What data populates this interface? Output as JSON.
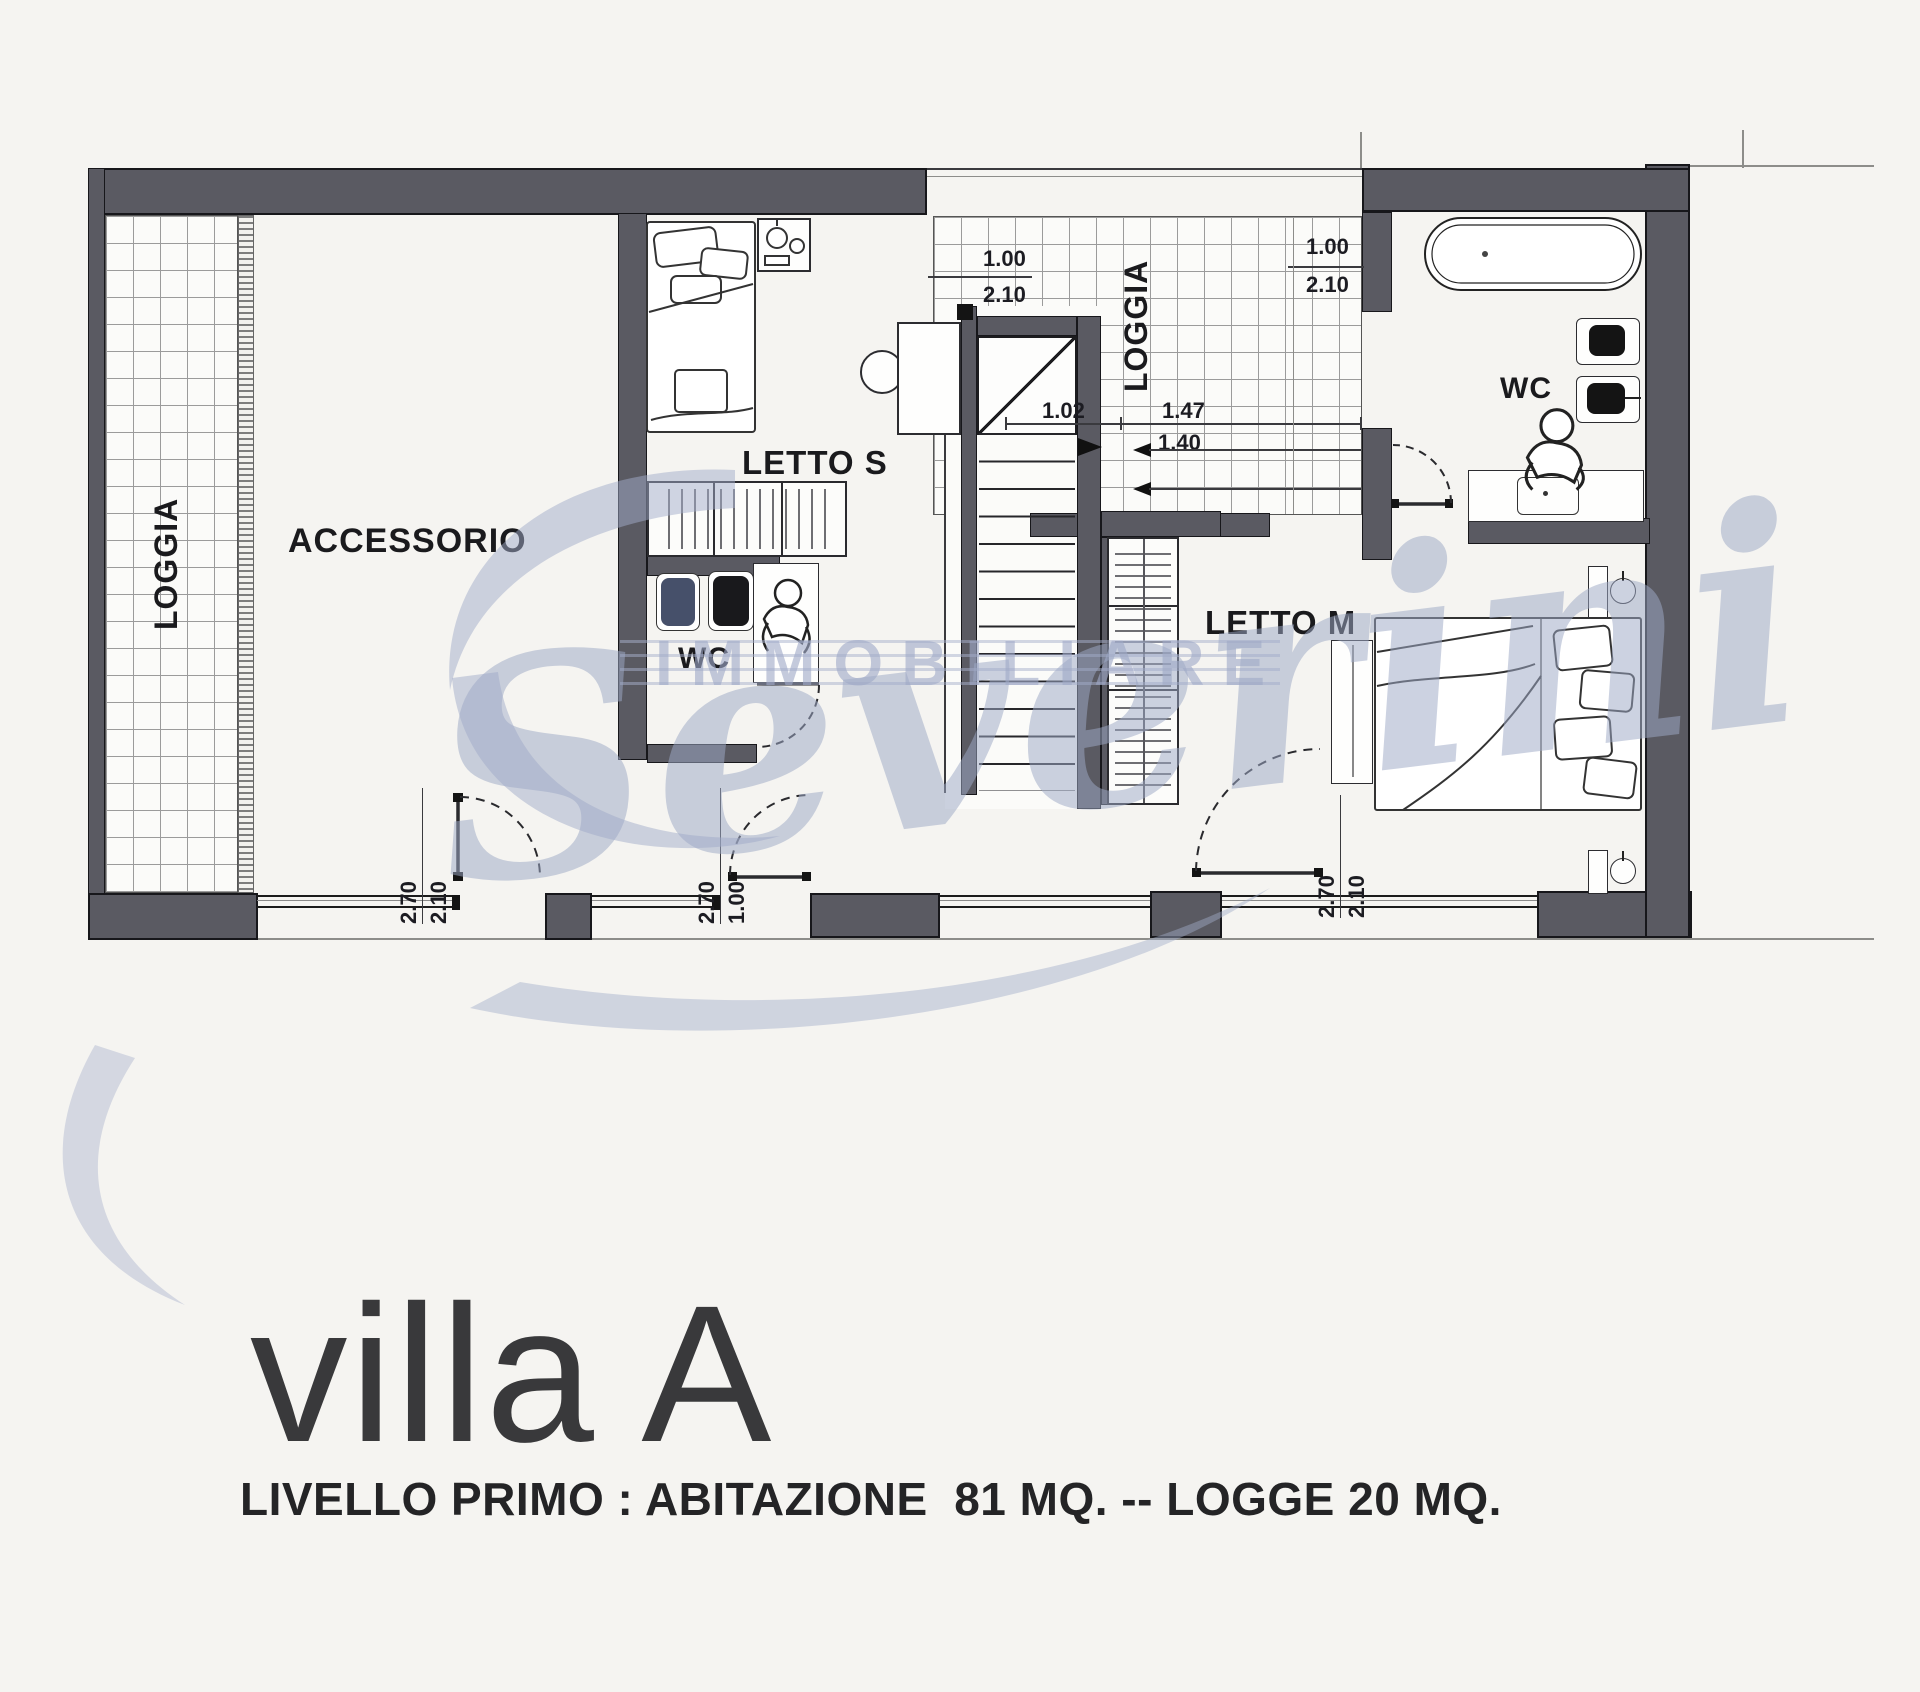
{
  "page": {
    "background": "#f5f4f1"
  },
  "plan": {
    "wall_color": "#5a5a62",
    "watermark_color": "#a7b0cc",
    "labels": {
      "loggia_left": "LOGGIA",
      "loggia_top": "LOGGIA",
      "accessorio": "ACCESSORIO",
      "letto_s": "LETTO S",
      "letto_m": "LETTO M",
      "wc_mid": "WC",
      "wc_right": "WC"
    },
    "dimensions": {
      "stair_door_top": [
        "1.00",
        "2.10"
      ],
      "wc_right_door": [
        "1.00",
        "2.10"
      ],
      "loggia_widths": [
        "1.02",
        "1.47"
      ],
      "loggia_clear": "1.40",
      "bottom_left_window": [
        "2.70",
        "2.10"
      ],
      "bottom_middle_door": [
        "2.70",
        "1.00"
      ],
      "bottom_right_window": [
        "2.70",
        "2.10"
      ]
    },
    "watermark": {
      "top": "IMMOBILIARE",
      "script": "Severini"
    }
  },
  "captions": {
    "title": "villa A",
    "subtitle": "LIVELLO PRIMO : ABITAZIONE  81 MQ. -- LOGGE 20 MQ."
  }
}
